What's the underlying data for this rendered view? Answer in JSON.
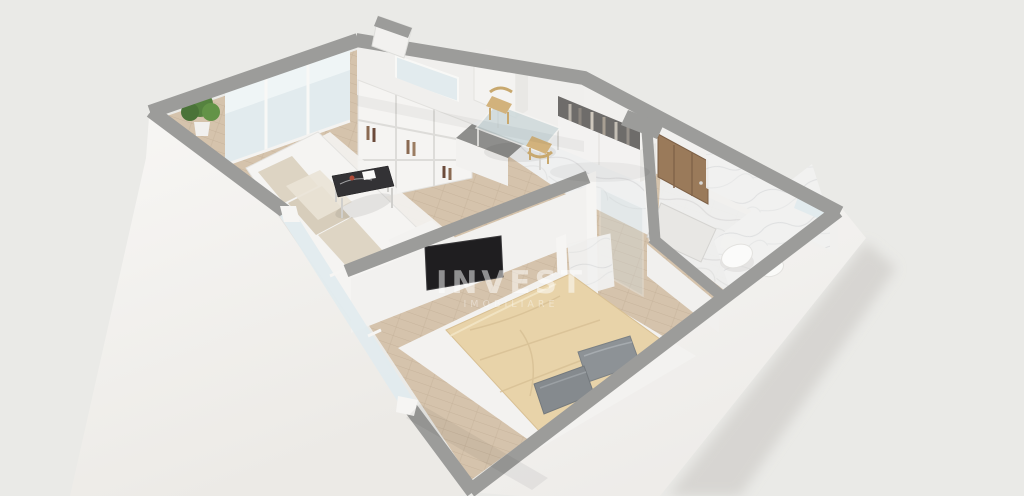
{
  "watermark": {
    "line1": "INVEST",
    "line2": "IMOBILIARE"
  },
  "palette": {
    "background": "#e8e7e4",
    "exterior_wall_face": "#f6f5f3",
    "wall_cap_gray": "#9c9c9a",
    "interior_wall_face": "#f1f0ee",
    "wood_floor": "#d5c3ac",
    "wood_plank_line": "#c2ae95",
    "marble_floor": "#eff0f0",
    "marble_vein": "#d9dadb",
    "window_glass": "#e2ebee",
    "rug_white": "#f3f2f0",
    "sofa_white": "#f5f4f2",
    "cushion_beige": "#ddd4c3",
    "coffee_table_black": "#333235",
    "tv_black": "#1f1e20",
    "duvet_beige": "#e8d3a9",
    "pillow_gray": "#8d9296",
    "entry_door_wood": "#9a7a5a",
    "plant_green": "#55823f",
    "counter_gray": "#8e8e8c",
    "chair_wood": "#d2b27c",
    "toilet_white": "#fbfbfa",
    "wardrobe_white": "#f3f2f1"
  },
  "rooms": [
    {
      "name": "living-room",
      "furniture": [
        "corner-sofa",
        "coffee-table",
        "shelving-unit",
        "plant",
        "panoramic-windows"
      ]
    },
    {
      "name": "kitchen",
      "furniture": [
        "kitchen-counter",
        "tall-cabinet",
        "glass-dining-table",
        "wood-chairs",
        "window"
      ]
    },
    {
      "name": "hallway",
      "furniture": [
        "wardrobe",
        "entry-door"
      ]
    },
    {
      "name": "bathroom",
      "furniture": [
        "wall-hung-toilet",
        "sink",
        "door",
        "small-window",
        "marble-walls"
      ]
    },
    {
      "name": "bedroom",
      "furniture": [
        "double-bed",
        "gray-pillows",
        "wall-tv",
        "white-rug",
        "window"
      ]
    }
  ]
}
